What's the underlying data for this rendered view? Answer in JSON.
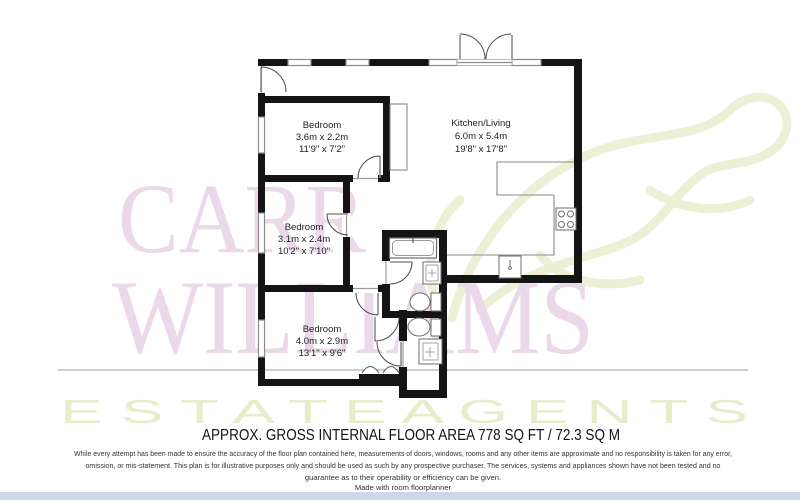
{
  "watermark": {
    "brand_line1": "CARR",
    "brand_line2": "WILLIAMS",
    "brand_line3": "E S T A T E    A G E N T S",
    "brand_color": "#ebd8e9",
    "accent_color": "#eef0d6"
  },
  "plan": {
    "rooms": [
      {
        "name": "Bedroom",
        "metric": "3.6m x 2.2m",
        "imperial": "11'9\" x 7'2\""
      },
      {
        "name": "Kitchen/Living",
        "metric": "6.0m x 5.4m",
        "imperial": "19'8\" x 17'8\""
      },
      {
        "name": "Bedroom",
        "metric": "3.1m x 2.4m",
        "imperial": "10'2\" x 7'10\""
      },
      {
        "name": "Bedroom",
        "metric": "4.0m x 2.9m",
        "imperial": "13'1\" x 9'6\""
      }
    ]
  },
  "footer": {
    "area_title": "APPROX. GROSS INTERNAL FLOOR AREA 778 SQ FT / 72.3 SQ M",
    "disclaimer_line1": "While every attempt has been made to ensure the accuracy of the floor plan contained here, measurements of doors, windows, rooms and any other items are approximate and no responsibility is taken for any error,",
    "disclaimer_line2": "omission, or mis-statement.  This plan is for illustrative purposes only and should be used as such by any prospective purchaser.  The services, systems and appliances shown have not been tested and no",
    "disclaimer_line3": "guarantee as to their operability or efficiency can be given.",
    "credit": "Made with room floorplanner"
  }
}
